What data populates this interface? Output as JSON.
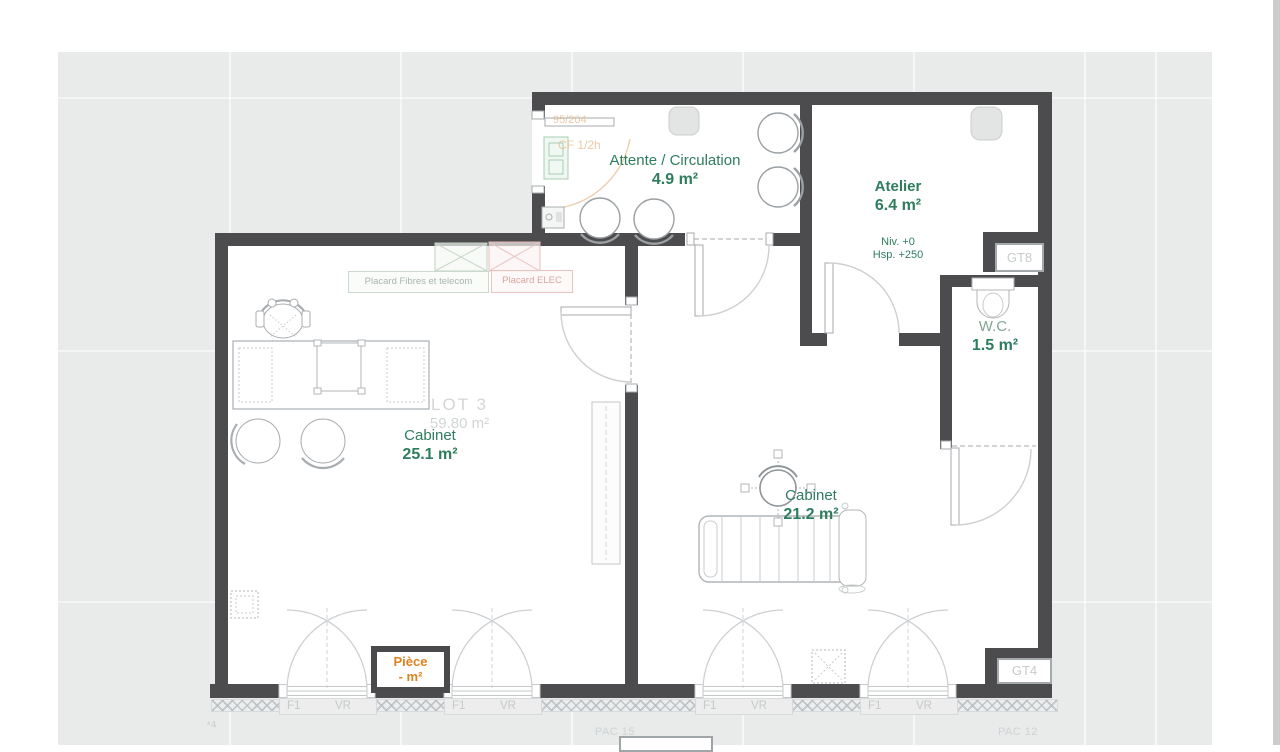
{
  "canvas": {
    "bg": "#e9eaea",
    "page_bg": "#ffffff",
    "wall_color": "#4c4c4e"
  },
  "colors": {
    "room_green": "#2e7d5e",
    "muted_green": "#83a596",
    "orange": "#df8220",
    "faint_gray": "#c9cdd0"
  },
  "rooms": {
    "attente": {
      "name": "Attente / Circulation",
      "area": "4.9 m²"
    },
    "atelier": {
      "name": "Atelier",
      "area": "6.4 m²",
      "level": "Niv. +0",
      "height": "Hsp. +250"
    },
    "wc": {
      "name": "W.C.",
      "area": "1.5 m²"
    },
    "cabinet_left": {
      "name": "Cabinet",
      "area": "25.1 m²"
    },
    "cabinet_right": {
      "name": "Cabinet",
      "area": "21.2 m²"
    },
    "piece": {
      "name": "Pièce",
      "area": "- m²"
    }
  },
  "lot": {
    "name": "LOT 3",
    "area": "59.80 m²"
  },
  "niches": {
    "gt8": "GT8",
    "gt4": "GT4"
  },
  "placards": {
    "fibres": "Placard Fibres et telecom",
    "elec": "Placard ELEC"
  },
  "fire_door": {
    "ref": "95/204",
    "rating": "CF 1/2h"
  },
  "bottom": {
    "sets": [
      {
        "f1": "F1",
        "vr": "VR"
      },
      {
        "f1": "F1",
        "vr": "VR"
      },
      {
        "f1": "F1",
        "vr": "VR"
      },
      {
        "f1": "F1",
        "vr": "VR"
      }
    ],
    "pac_left": "PAC 15",
    "pac_right": "PAC 12",
    "note": "*4"
  }
}
